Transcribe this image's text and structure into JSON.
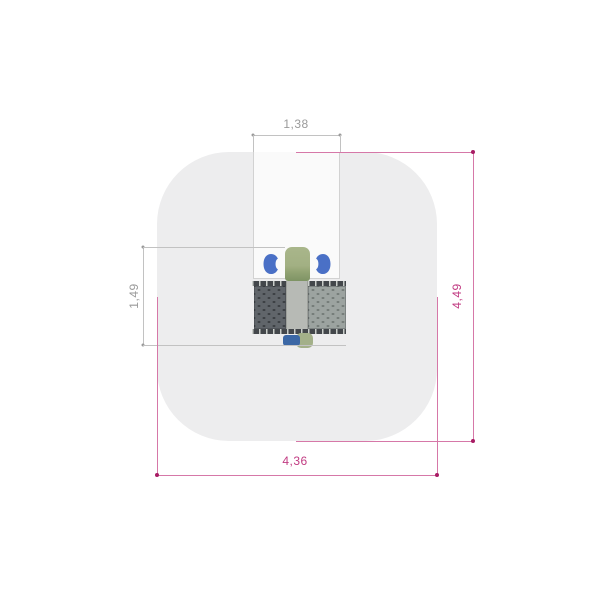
{
  "drawing": {
    "safety_zone": {
      "fill": "#ededee",
      "width_label": "4,36",
      "height_label": "4,49"
    },
    "equipment": {
      "clearance_width_label": "1,38",
      "clearance_depth_label": "1,49",
      "colors": {
        "body_green": "#9fae80",
        "grip_blue": "#4a70c6",
        "tread_dark": "#60656a",
        "tread_light": "#9ca3a0",
        "deck_center": "#b7bab5",
        "footrest_blue": "#3b67a5",
        "footrest_green": "#a3b089"
      }
    },
    "dimension_styles": {
      "primary_color": "#c13b82",
      "secondary_color": "#9a9a9a"
    }
  }
}
